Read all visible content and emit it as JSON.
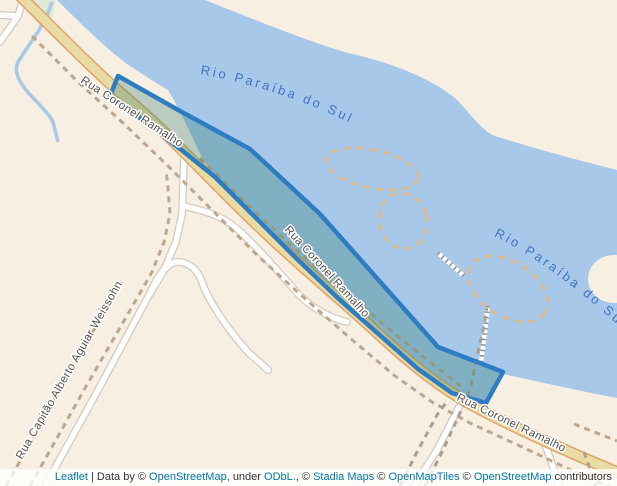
{
  "map": {
    "river": {
      "name": "Rio Paraíba do Sul",
      "name_clipped": "Rio Paraíba do Sul"
    },
    "streets": {
      "coronel_ramalho": "Rua Coronel Ramalho",
      "capitao_weissohn": "Rua Capitão Alberto Aguiar Weissohn"
    },
    "colors": {
      "water": "#a8c8e9",
      "land": "#f6efe2",
      "green_area": "#dfe9d3",
      "road_fill": "#e8dba4",
      "road_casing": "#e2a266",
      "minor_road_fill": "#ffffff",
      "minor_road_casing": "#d2cabf",
      "path_dash": "#bfa78d",
      "path_dash_grey": "#a9a093",
      "sandbank_dash": "#d9ba95",
      "pier": "#ffffff",
      "pier_tick": "#8d8d8d",
      "highlight_stroke": "#2e7dc3",
      "highlight_fill": "#2c7c6c",
      "river_label": "#3e74c4",
      "street_label": "#57504a"
    }
  },
  "attribution": {
    "link_color": "#0078a8",
    "parts": [
      {
        "text": "Leaflet",
        "link": true
      },
      {
        "text": " | Data by © ",
        "link": false
      },
      {
        "text": "OpenStreetMap",
        "link": true
      },
      {
        "text": ", under ",
        "link": false
      },
      {
        "text": "ODbL.",
        "link": true
      },
      {
        "text": ", © ",
        "link": false
      },
      {
        "text": "Stadia Maps",
        "link": true
      },
      {
        "text": " © ",
        "link": false
      },
      {
        "text": "OpenMapTiles",
        "link": true
      },
      {
        "text": " © ",
        "link": false
      },
      {
        "text": "OpenStreetMap",
        "link": true
      },
      {
        "text": " contributors",
        "link": false
      }
    ]
  }
}
